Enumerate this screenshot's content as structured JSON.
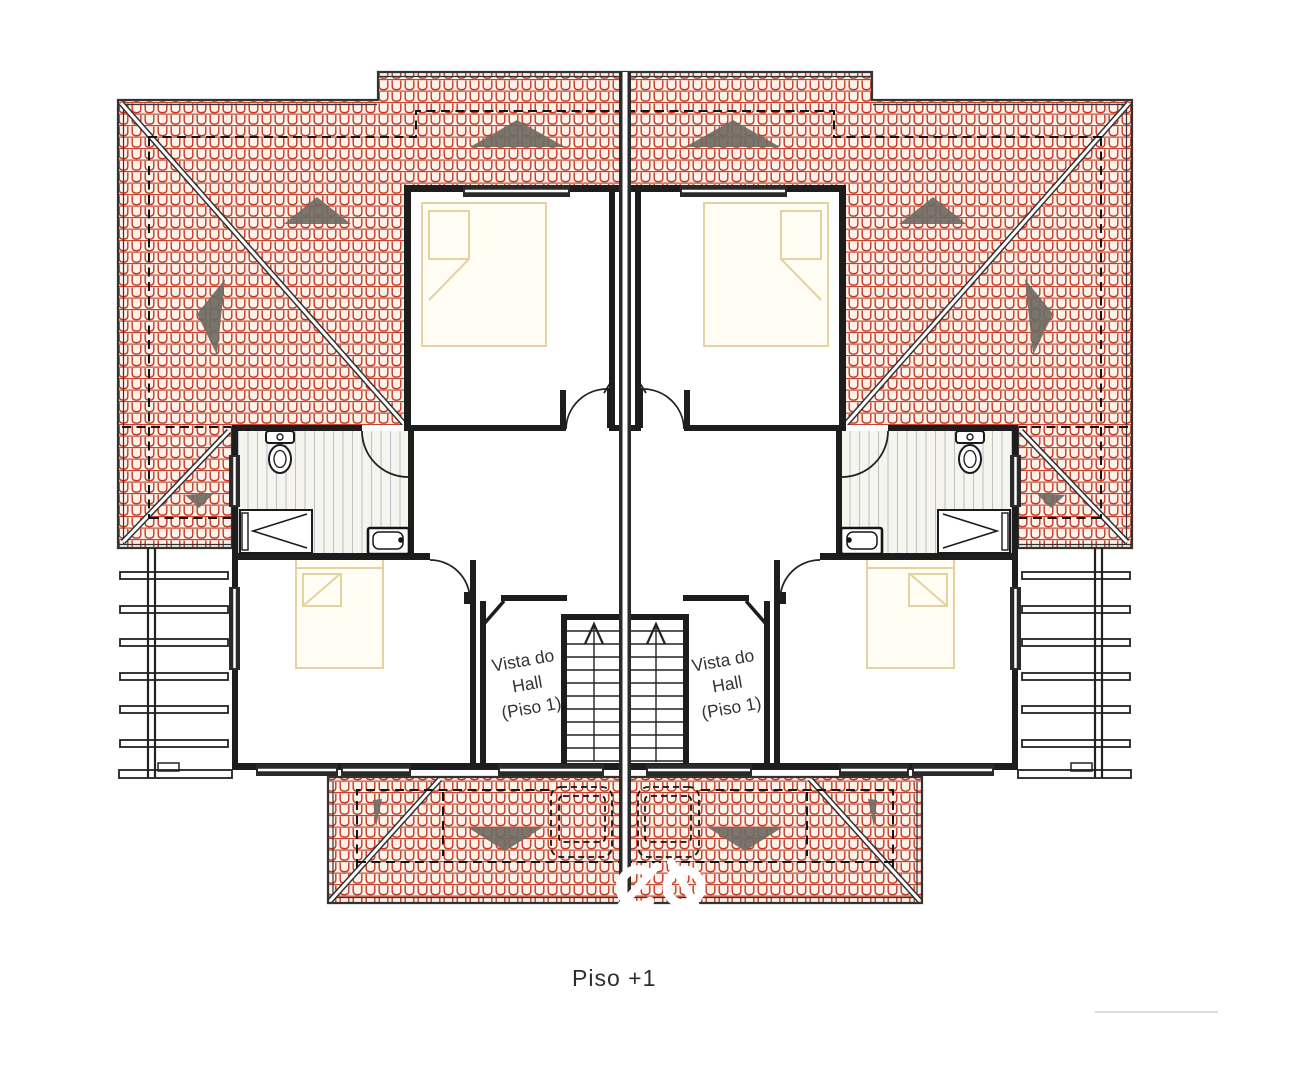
{
  "plan": {
    "floor_label": "Piso +1",
    "hall_view_label": {
      "line1": "Vista do",
      "line2": "Hall",
      "line3": "(Piso 1)"
    },
    "colors": {
      "roof_tile_red": "#c23a25",
      "roof_tile_bg": "#fdf2ea",
      "slope_arrow_gray": "#6f6b63",
      "wall": "#1d1d1d",
      "bathroom_stripe": "#bfc3c9",
      "bed_outline": "#e5d2a0",
      "dashed_line": "#141414",
      "watermark": "#ffffff"
    },
    "elements": [
      "hip-roof-with-tiles",
      "slope-arrow-icon",
      "party-wall",
      "bedroom",
      "bed",
      "bathroom",
      "toilet-icon",
      "shower-icon",
      "sink-icon",
      "staircase",
      "hall-void",
      "pergola-beams",
      "porch-roof",
      "watermark-logo",
      "window",
      "door-swing"
    ]
  }
}
